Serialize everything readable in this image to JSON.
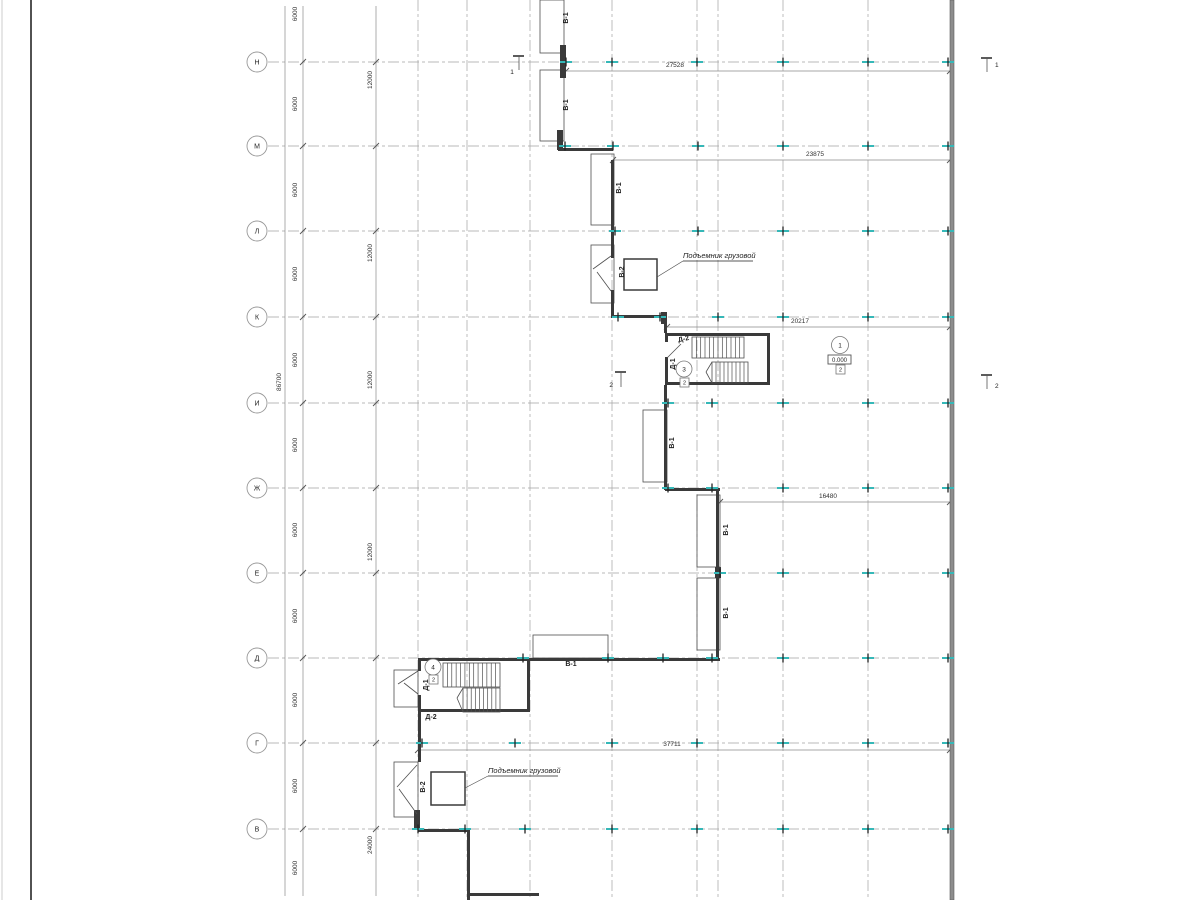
{
  "colors": {
    "wall": "#3a3a3a",
    "thin": "#4f4f4f",
    "grid": "#a3a3a3",
    "dim": "#8a8a8a",
    "teal": "#35b8b8",
    "text": "#1f1f1f",
    "heavy_wall_fill": "#8d8d8d",
    "heavy_wall_edge": "#5a5a5a",
    "frame_light": "#cccccc",
    "frame_dark": "#3f3f3f"
  },
  "frame": {
    "light_x": 2,
    "dark_x": 31
  },
  "axis_circle": {
    "cx": 257,
    "r": 10
  },
  "axis_rows": [
    {
      "label": "Н",
      "y": 62
    },
    {
      "label": "М",
      "y": 146
    },
    {
      "label": "Л",
      "y": 231
    },
    {
      "label": "К",
      "y": 317
    },
    {
      "label": "И",
      "y": 403
    },
    {
      "label": "Ж",
      "y": 488
    },
    {
      "label": "Е",
      "y": 573
    },
    {
      "label": "Д",
      "y": 658
    },
    {
      "label": "Г",
      "y": 743
    },
    {
      "label": "В",
      "y": 829
    }
  ],
  "grid_extent": {
    "x1": 268,
    "x2": 950,
    "y1": 0,
    "y2": 900
  },
  "v_gridlines": [
    418,
    467,
    530,
    612,
    697,
    718,
    783,
    868
  ],
  "dim_columns": [
    {
      "x": 285,
      "labels": [
        {
          "text": "86700",
          "x": 281,
          "y": 382,
          "rot": -90
        }
      ],
      "ticks": []
    },
    {
      "x": 303,
      "labels": [
        {
          "text": "6000",
          "x": 297,
          "y": 14,
          "rot": -90
        },
        {
          "text": "6000",
          "x": 297,
          "y": 104,
          "rot": -90
        },
        {
          "text": "6000",
          "x": 297,
          "y": 190,
          "rot": -90
        },
        {
          "text": "6000",
          "x": 297,
          "y": 274,
          "rot": -90
        },
        {
          "text": "6000",
          "x": 297,
          "y": 360,
          "rot": -90
        },
        {
          "text": "6000",
          "x": 297,
          "y": 445,
          "rot": -90
        },
        {
          "text": "6000",
          "x": 297,
          "y": 530,
          "rot": -90
        },
        {
          "text": "6000",
          "x": 297,
          "y": 616,
          "rot": -90
        },
        {
          "text": "6000",
          "x": 297,
          "y": 700,
          "rot": -90
        },
        {
          "text": "6000",
          "x": 297,
          "y": 786,
          "rot": -90
        },
        {
          "text": "6000",
          "x": 297,
          "y": 868,
          "rot": -90
        }
      ],
      "ticks": [
        62,
        146,
        231,
        317,
        403,
        488,
        573,
        658,
        743,
        829
      ]
    },
    {
      "x": 376,
      "labels": [
        {
          "text": "12000",
          "x": 372,
          "y": 80,
          "rot": -90
        },
        {
          "text": "12000",
          "x": 372,
          "y": 253,
          "rot": -90
        },
        {
          "text": "12000",
          "x": 372,
          "y": 380,
          "rot": -90
        },
        {
          "text": "12000",
          "x": 372,
          "y": 552,
          "rot": -90
        },
        {
          "text": "24000",
          "x": 372,
          "y": 845,
          "rot": -90
        }
      ],
      "ticks": [
        62,
        146,
        231,
        317,
        403,
        488,
        573,
        658,
        743,
        829
      ]
    }
  ],
  "dim_lines_horizontal": [
    {
      "text": "27528",
      "y": 71,
      "x1": 566,
      "x2": 950,
      "tx": 675,
      "ty": 67
    },
    {
      "text": "23875",
      "y": 160,
      "x1": 613,
      "x2": 950,
      "tx": 815,
      "ty": 156
    },
    {
      "text": "20217",
      "y": 327,
      "x1": 667,
      "x2": 950,
      "tx": 800,
      "ty": 323
    },
    {
      "text": "16480",
      "y": 502,
      "x1": 720,
      "x2": 950,
      "tx": 828,
      "ty": 498
    },
    {
      "text": "37711",
      "y": 750,
      "x1": 418,
      "x2": 950,
      "tx": 672,
      "ty": 746
    }
  ],
  "heavy_wall": {
    "x": 950,
    "y": 0,
    "w": 4,
    "h": 900
  },
  "walls": [
    [
      558,
      148,
      55,
      3
    ],
    [
      611,
      160,
      3,
      98
    ],
    [
      611,
      290,
      3,
      28
    ],
    [
      613,
      315,
      54,
      3
    ],
    [
      664,
      318,
      3,
      15
    ],
    [
      665,
      333,
      105,
      3
    ],
    [
      665,
      333,
      3,
      9
    ],
    [
      665,
      357,
      3,
      28
    ],
    [
      767,
      333,
      3,
      52
    ],
    [
      665,
      382,
      105,
      3
    ],
    [
      664,
      385,
      3,
      105
    ],
    [
      665,
      488,
      55,
      3
    ],
    [
      716,
      488,
      3,
      79
    ],
    [
      716,
      578,
      3,
      82
    ],
    [
      418,
      658,
      302,
      3
    ],
    [
      418,
      658,
      3,
      13
    ],
    [
      418,
      695,
      3,
      17
    ],
    [
      527,
      658,
      3,
      54
    ],
    [
      418,
      709,
      112,
      3
    ],
    [
      418,
      712,
      3,
      50
    ],
    [
      418,
      829,
      52,
      3
    ],
    [
      467,
      832,
      3,
      68
    ],
    [
      467,
      893,
      72,
      3
    ]
  ],
  "piers": [
    [
      560,
      45,
      6,
      33
    ],
    [
      557,
      130,
      6,
      20
    ],
    [
      661,
      312,
      6,
      12
    ],
    [
      715,
      567,
      6,
      11
    ],
    [
      414,
      810,
      6,
      19
    ]
  ],
  "thin_rects": [
    [
      540,
      0,
      24,
      53
    ],
    [
      540,
      70,
      24,
      71
    ],
    [
      591,
      154,
      23,
      71
    ],
    [
      591,
      245,
      23,
      58
    ],
    [
      643,
      410,
      24,
      72
    ],
    [
      697,
      495,
      23,
      72
    ],
    [
      697,
      578,
      23,
      72
    ],
    [
      533,
      635,
      75,
      23
    ],
    [
      394,
      670,
      24,
      37
    ],
    [
      394,
      762,
      24,
      55
    ]
  ],
  "door_lines": [
    [
      611,
      256,
      593,
      269
    ],
    [
      611,
      291,
      597,
      272
    ],
    [
      667,
      358,
      681,
      344
    ],
    [
      418,
      671,
      398,
      684
    ],
    [
      418,
      694,
      404,
      683
    ],
    [
      417,
      765,
      397,
      787
    ],
    [
      417,
      814,
      399,
      789
    ]
  ],
  "stairs": [
    {
      "x1": 692,
      "y1": 337,
      "x2": 744,
      "y2": 358,
      "n": 12
    },
    {
      "x1": 712,
      "y1": 362,
      "x2": 748,
      "y2": 383,
      "n": 9
    },
    {
      "x1": 443,
      "y1": 663,
      "x2": 500,
      "y2": 687,
      "n": 13
    },
    {
      "x1": 463,
      "y1": 688,
      "x2": 500,
      "y2": 712,
      "n": 9
    }
  ],
  "break_lines": [
    [
      712,
      362,
      706,
      372,
      712,
      383
    ],
    [
      463,
      688,
      457,
      698,
      463,
      712
    ]
  ],
  "lift_shafts": [
    [
      624,
      259,
      33,
      31
    ],
    [
      431,
      772,
      34,
      33
    ]
  ],
  "lift_notes": [
    {
      "text": "Подъемник грузовой",
      "x": 683,
      "y": 258,
      "ux1": 683,
      "ux2": 753,
      "uy": 261,
      "leader": [
        683,
        261,
        657,
        277
      ]
    },
    {
      "text": "Подъемник грузовой",
      "x": 488,
      "y": 773,
      "ux1": 488,
      "ux2": 558,
      "uy": 776,
      "leader": [
        488,
        776,
        465,
        788
      ]
    }
  ],
  "wall_labels": [
    {
      "text": "В-1",
      "x": 568,
      "y": 18,
      "rot": -90
    },
    {
      "text": "В-1",
      "x": 568,
      "y": 105,
      "rot": -90
    },
    {
      "text": "В-1",
      "x": 621,
      "y": 188,
      "rot": -90
    },
    {
      "text": "В-1",
      "x": 674,
      "y": 443,
      "rot": -90
    },
    {
      "text": "В-1",
      "x": 728,
      "y": 530,
      "rot": -90
    },
    {
      "text": "В-1",
      "x": 728,
      "y": 613,
      "rot": -90
    },
    {
      "text": "В-1",
      "x": 571,
      "y": 666,
      "rot": 0
    },
    {
      "text": "В-2",
      "x": 624,
      "y": 272,
      "rot": -90
    },
    {
      "text": "В-2",
      "x": 425,
      "y": 787,
      "rot": -90
    },
    {
      "text": "Д-2",
      "x": 684,
      "y": 341,
      "rot": -12
    },
    {
      "text": "Д-2",
      "x": 431,
      "y": 719,
      "rot": 0
    },
    {
      "text": "Д-1",
      "x": 675,
      "y": 364,
      "rot": -90
    },
    {
      "text": "Д-1",
      "x": 428,
      "y": 685,
      "rot": -90
    }
  ],
  "ref_circles": [
    {
      "text": "1",
      "cx": 840,
      "cy": 345,
      "r": 8.5
    },
    {
      "text": "3",
      "cx": 684,
      "cy": 369,
      "r": 8
    },
    {
      "text": "4",
      "cx": 433,
      "cy": 667,
      "r": 8
    }
  ],
  "tag_boxes": [
    {
      "text": "2",
      "x": 836,
      "y": 365,
      "s": 9
    },
    {
      "text": "2",
      "x": 680,
      "y": 378,
      "s": 9
    },
    {
      "text": "2",
      "x": 429,
      "y": 675,
      "s": 9
    }
  ],
  "level_mark": {
    "text": "0.000",
    "x": 828,
    "y": 355,
    "w": 23,
    "h": 9
  },
  "section_marks": [
    {
      "text": "1",
      "capx1": 513,
      "capx2": 524,
      "capy": 56,
      "sx": 519,
      "sy1": 56,
      "sy2": 70,
      "lx": 512,
      "ly": 74,
      "anchor": "middle"
    },
    {
      "text": "1",
      "capx1": 981,
      "capx2": 992,
      "capy": 58,
      "sx": 987,
      "sy1": 58,
      "sy2": 72,
      "lx": 995,
      "ly": 67,
      "anchor": "start"
    },
    {
      "text": "2",
      "capx1": 615,
      "capx2": 626,
      "capy": 372,
      "sx": 621,
      "sy1": 372,
      "sy2": 387,
      "lx": 613,
      "ly": 387,
      "anchor": "end"
    },
    {
      "text": "2",
      "capx1": 981,
      "capx2": 992,
      "capy": 375,
      "sx": 987,
      "sy1": 375,
      "sy2": 389,
      "lx": 995,
      "ly": 388,
      "anchor": "start"
    }
  ],
  "column_ticks": [
    {
      "y": 62,
      "xs": [
        566,
        612,
        697,
        783,
        868,
        948
      ]
    },
    {
      "y": 146,
      "xs": [
        565,
        613,
        698,
        783,
        868,
        948
      ]
    },
    {
      "y": 231,
      "xs": [
        615,
        698,
        783,
        868,
        948
      ]
    },
    {
      "y": 317,
      "xs": [
        618,
        660,
        718,
        783,
        868,
        948
      ]
    },
    {
      "y": 403,
      "xs": [
        668,
        712,
        783,
        868,
        948
      ]
    },
    {
      "y": 488,
      "xs": [
        668,
        712,
        783,
        868,
        948
      ]
    },
    {
      "y": 573,
      "xs": [
        720,
        783,
        868,
        948
      ]
    },
    {
      "y": 658,
      "xs": [
        523,
        608,
        663,
        712,
        783,
        868,
        948
      ]
    },
    {
      "y": 743,
      "xs": [
        422,
        515,
        612,
        697,
        783,
        868,
        948
      ]
    },
    {
      "y": 829,
      "xs": [
        418,
        465,
        525,
        612,
        697,
        783,
        868,
        948
      ]
    }
  ]
}
